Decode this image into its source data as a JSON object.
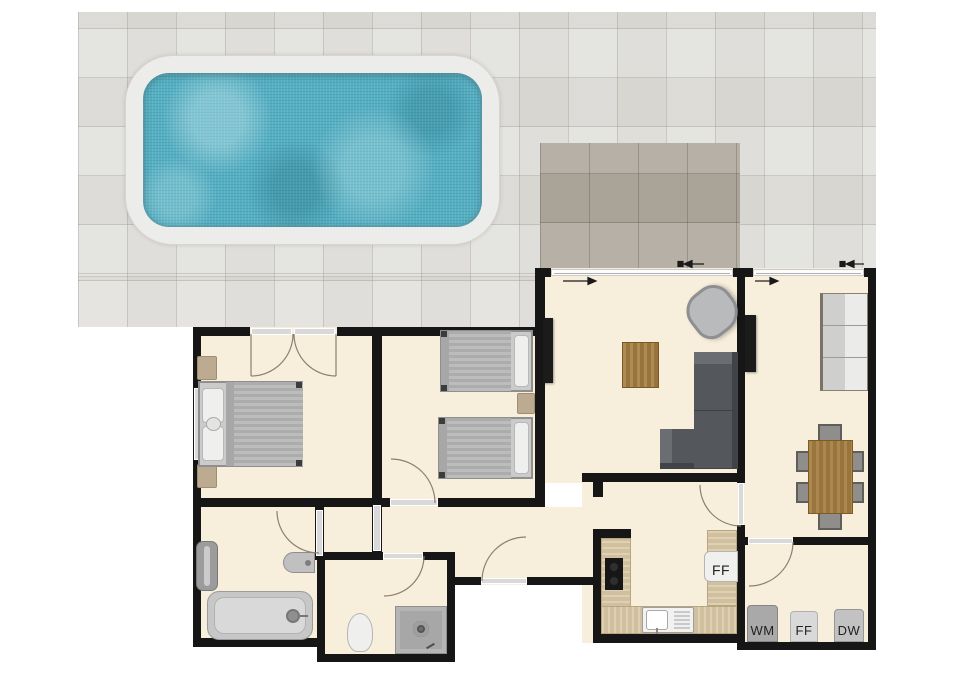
{
  "labels": {
    "kitchen_fridge_freezer": "FF",
    "washing_machine": "WM",
    "utility_fridge_freezer": "FF",
    "dishwasher": "DW"
  },
  "colors": {
    "wall": "#161616",
    "floor": "#f7eedb",
    "patio": "#e1e0dc",
    "terrace": "#b2aba0",
    "deck": "#ececea",
    "water": "#55afc2",
    "glass": "#d9d9d9",
    "arc": "#8d7f6f",
    "counter": "#d9c8a5",
    "table_wood": "#a27b3e",
    "sofa_dark": "#54575b",
    "appliance_text": "#222222"
  }
}
